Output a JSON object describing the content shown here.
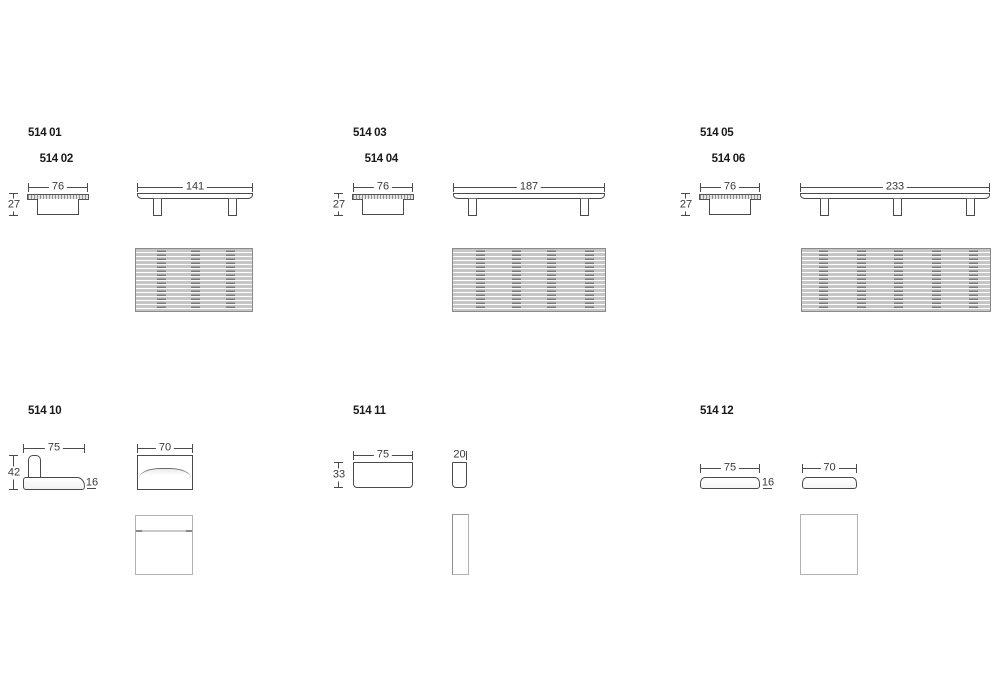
{
  "colors": {
    "line": "#4a4a4a",
    "dimtext": "#3a3a3a",
    "label": "#1a1a1a",
    "slat": "#c6c6c6",
    "plan": "#b2b2b2"
  },
  "groups": [
    {
      "labels": [
        "514 01",
        "514 02"
      ],
      "dims": {
        "side_width": "76",
        "side_height": "27",
        "front_width": "141"
      }
    },
    {
      "labels": [
        "514 03",
        "514 04"
      ],
      "dims": {
        "side_width": "76",
        "side_height": "27",
        "front_width": "187"
      }
    },
    {
      "labels": [
        "514 05",
        "514 06"
      ],
      "dims": {
        "side_width": "76",
        "side_height": "27",
        "front_width": "233"
      }
    },
    {
      "labels": [
        "514 10"
      ],
      "dims": {
        "seat_width": "75",
        "total_height": "42",
        "cushion_height": "16",
        "front_width": "70"
      }
    },
    {
      "labels": [
        "514 11"
      ],
      "dims": {
        "width": "75",
        "height": "33",
        "depth": "20"
      }
    },
    {
      "labels": [
        "514 12"
      ],
      "dims": {
        "left_width": "75",
        "height": "16",
        "right_width": "70"
      }
    }
  ]
}
